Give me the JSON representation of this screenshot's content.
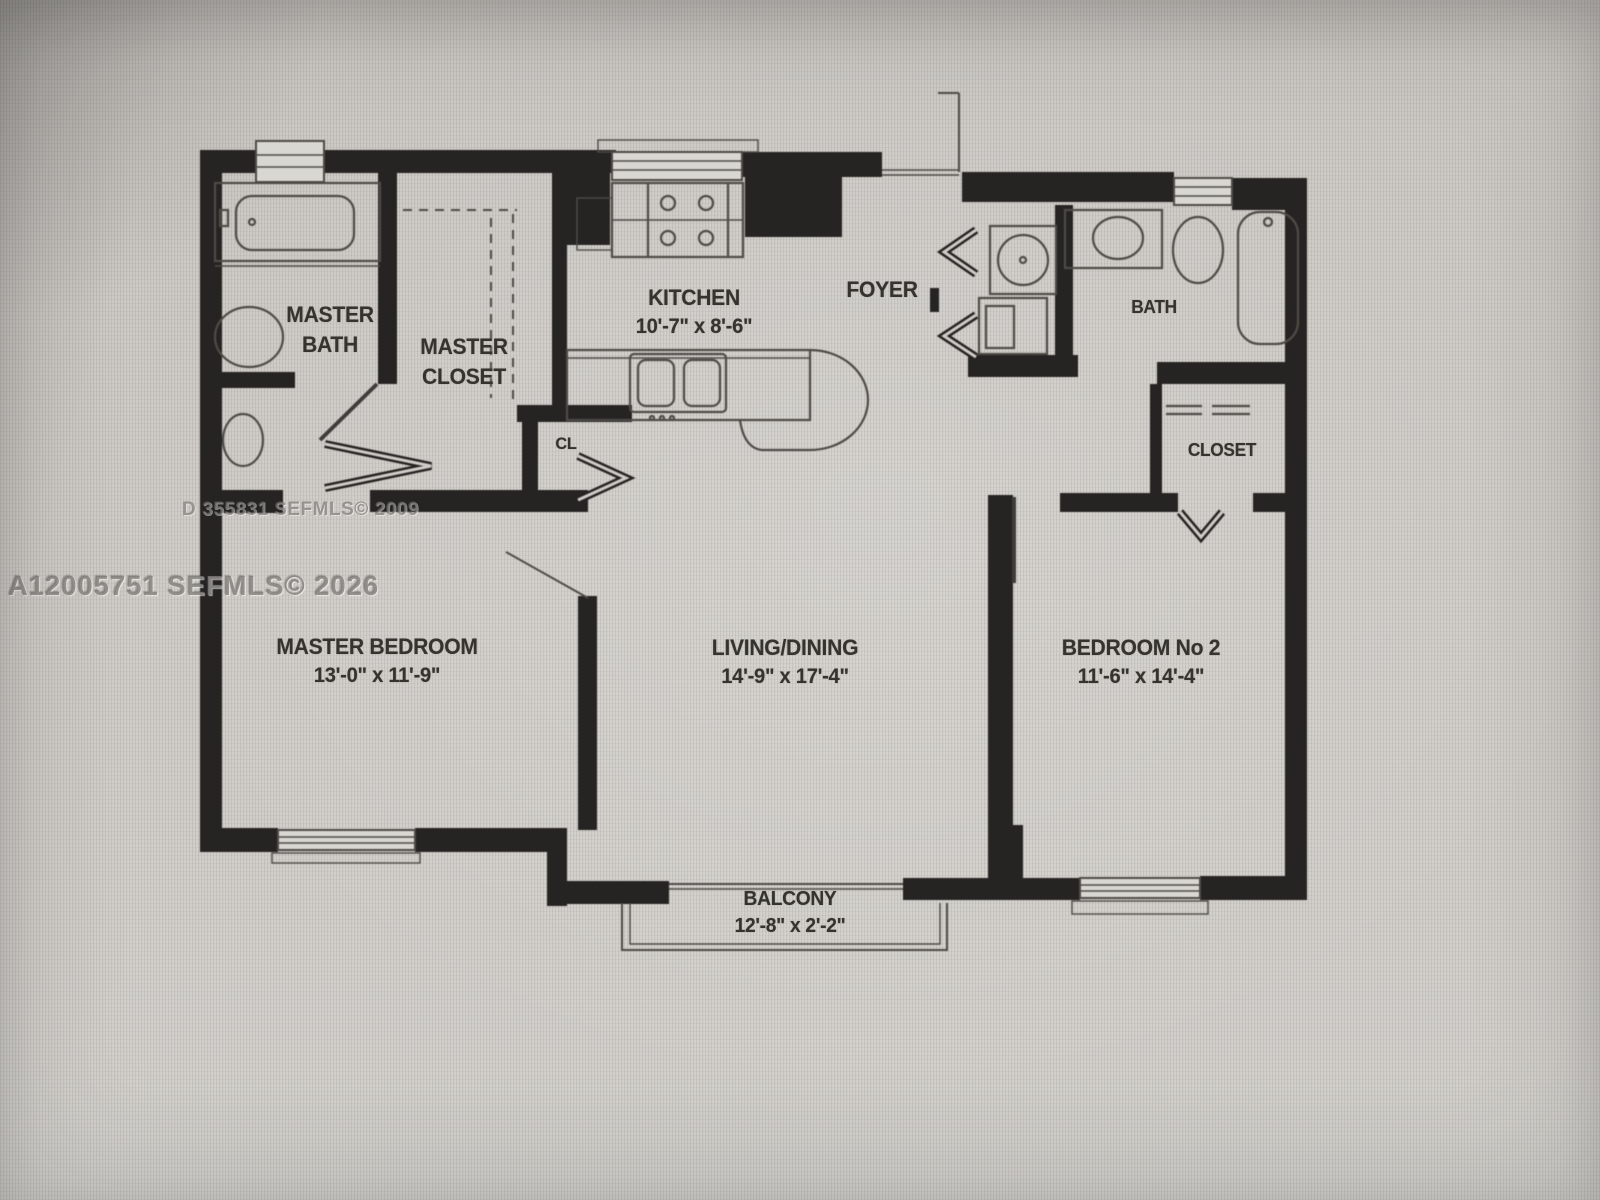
{
  "photo": {
    "type": "floor-plan-photo",
    "watermark_left": "A12005751  SEFMLS© 2026",
    "watermark_plan": "D 355831  SEFMLS© 2009"
  },
  "rooms": {
    "master_bath": {
      "line1": "MASTER",
      "line2": "BATH"
    },
    "master_closet": {
      "line1": "MASTER",
      "line2": "CLOSET"
    },
    "kitchen": {
      "name": "KITCHEN",
      "dims": "10'-7\" x 8'-6\""
    },
    "foyer": {
      "name": "FOYER"
    },
    "bath": {
      "name": "BATH"
    },
    "closet": {
      "name": "CLOSET"
    },
    "cl_closet": {
      "name": "CL"
    },
    "master_bedroom": {
      "name": "MASTER BEDROOM",
      "dims": "13'-0\" x 11'-9\""
    },
    "living_dining": {
      "name": "LIVING/DINING",
      "dims": "14'-9\" x 17'-4\""
    },
    "bedroom_2": {
      "name": "BEDROOM No 2",
      "dims": "11'-6\" x 14'-4\""
    },
    "balcony": {
      "name": "BALCONY",
      "dims": "12'-8\" x 2'-2\""
    }
  },
  "colors": {
    "wall": "#262422",
    "line": "#4e4b47",
    "label": "#35332e",
    "background": "#cfccc7"
  }
}
